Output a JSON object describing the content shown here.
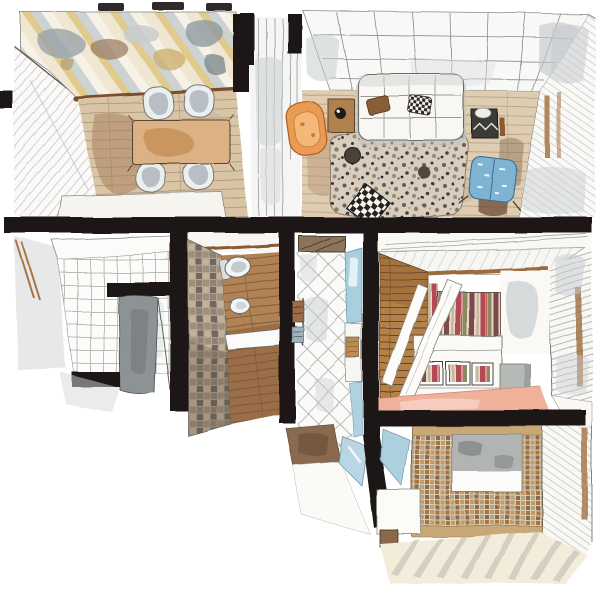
{
  "title": "Watercolor axonometric floor plan of an apartment",
  "description": "Hand-painted watercolor cutaway plan showing dining room with world-map mural, living room, entry hall, toilet room, shower room, bedroom and laundry bathroom. No visible text in the artwork.",
  "palette": {
    "paper": "#ffffff",
    "ink": "#1b1713",
    "wood_floor": "#d9c5a6",
    "wood_dark": "#a67c55",
    "plank_line": "#a08a72",
    "table": "#dcb184",
    "table_stain": "#b97f45",
    "mural_cream": "#efe7d2",
    "mural_yellow": "#e0ca8c",
    "mural_gray": "#cdd2d2",
    "map_gray": "#9aa3a8",
    "map_brown": "#9b7f63",
    "map_olive": "#cdb071",
    "chair_shell": "#eceff0",
    "chair_shadow": "#aeb6bd",
    "sofa": "#f8f7f3",
    "rug_base": "#d8cec0",
    "orange": "#e99a52",
    "orange_deep": "#b05f1f",
    "blue_chair": "#7fb3d4",
    "glass_blue": "#a9cede",
    "stone_a": "#8d8378",
    "stone_b": "#a08f7a",
    "stone_c": "#6f675e",
    "stone_d": "#c0b29c",
    "wc_floor": "#b08256",
    "wood_wall": "#b48148",
    "lintel": "#9c6a3c",
    "stripe_red": "#b24a52",
    "stripe_olive": "#8a8a5e",
    "stripe_cream": "#e3d9c4",
    "stripe_maroon": "#7e4a4e",
    "pink_floor": "#f0b19b",
    "mosaic_a": "#c49a66",
    "mosaic_b": "#a5763f",
    "mosaic_c": "#b3a58c",
    "mosaic_d": "#8c6b4a",
    "mosaic_bg": "#d8cbb4",
    "cream_floor": "#f4ecda",
    "streak": "#b9b9b2",
    "towel_brown": "#9c6b4a",
    "towel_blue": "#9fb3bd",
    "mat_brown": "#8a6a50",
    "gray_wash": "#c9cdcf",
    "door_gray": "#8d9395"
  },
  "rooms": [
    {
      "id": "dining",
      "label": "Dining room",
      "items": [
        "world-map striped mural wall",
        "wooden dining table",
        "four shell chairs",
        "white bench",
        "plank wood floor",
        "sketched side wall"
      ]
    },
    {
      "id": "living",
      "label": "Living room",
      "items": [
        "white tufted sofa",
        "two throw pillows",
        "speckled terrazzo rug",
        "orange armchair",
        "wooden side table with kettle",
        "dark plant table",
        "blue patterned armchair",
        "black-white checkered table",
        "tiled back wall",
        "paneled right wall with door frame"
      ]
    },
    {
      "id": "hallway",
      "label": "Glass hallway",
      "items": [
        "glass partition panels",
        "black wall stubs"
      ]
    },
    {
      "id": "entry",
      "label": "Entry hall",
      "items": [
        "white tile floor",
        "open gray door",
        "black door jambs",
        "wood trim",
        "white canopy shelf"
      ]
    },
    {
      "id": "wc",
      "label": "Toilet room",
      "items": [
        "stone mosaic wall",
        "toilet",
        "bidet",
        "floating white shelf",
        "dark wood floor"
      ]
    },
    {
      "id": "shower",
      "label": "Shower room",
      "items": [
        "diamond tile floor",
        "blue glass panels",
        "glass swing door",
        "teak bench",
        "towel rail with towels",
        "ceiling vent",
        "brown bath mat"
      ]
    },
    {
      "id": "bedroom",
      "label": "Bedroom",
      "items": [
        "striped headboard wall",
        "plank wood wall",
        "white canopy beams",
        "white bed with striped pillows",
        "gray cube nightstand",
        "salmon pink floor",
        "louvered window wall",
        "window sill"
      ]
    },
    {
      "id": "laundry",
      "label": "Laundry bathroom",
      "items": [
        "mosaic tile wall",
        "built-in appliance niche",
        "white cabinet",
        "wooden stool",
        "blue glass shard",
        "streaked cream floor",
        "hatched right wall"
      ]
    }
  ]
}
